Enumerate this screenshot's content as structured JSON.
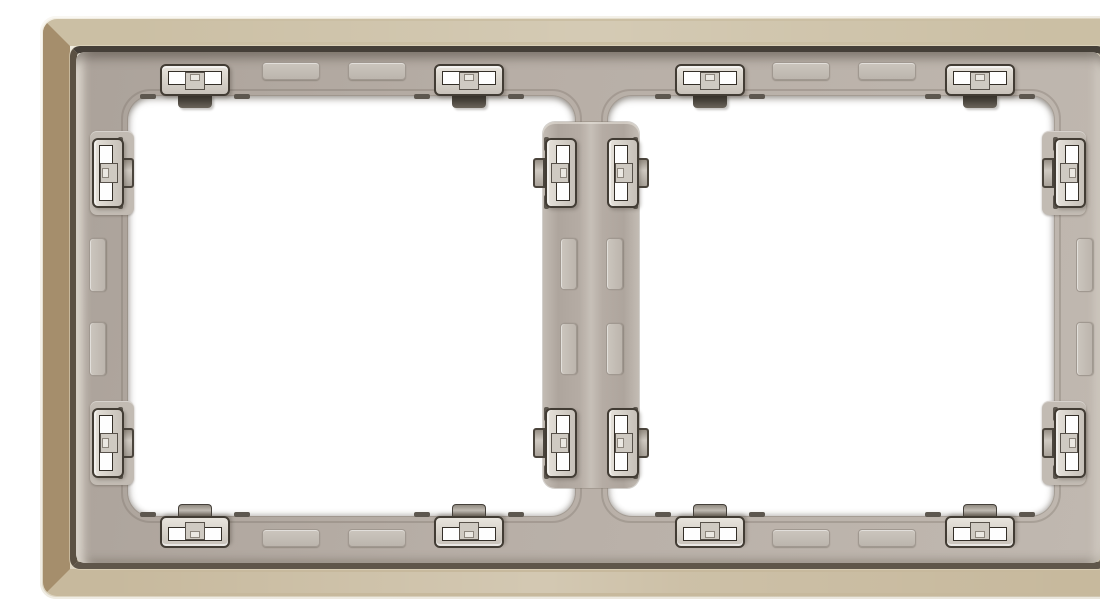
{
  "image": {
    "title": "Rear view of a two-gang champagne metallic wall-switch cover frame with grey plastic carrier and snap-in mounting clips",
    "type": "product-photo",
    "background": "#ffffff"
  },
  "product": {
    "kind": "wall switch cover frame",
    "view": "rear",
    "gangs": 2,
    "finish": "champagne metallic",
    "carrier_material": "grey plastic",
    "openings": [
      "left",
      "right"
    ],
    "clips_total": 16,
    "clips_per_opening": 8,
    "clip_positions": [
      "top-left",
      "top-right",
      "bottom-left",
      "bottom-right",
      "left-upper",
      "left-lower",
      "right-upper",
      "right-lower"
    ],
    "relief_bumps_total": 16
  },
  "colors": {
    "frame_top": "#cbbfa4",
    "frame_left": "#a58e6c",
    "frame_right": "#b29d7d",
    "frame_bottom": "#c7b99d",
    "frame_edge_light": "#f0ebdf",
    "seam_dark": "#453f38",
    "carrier_grey": "#b5aca4",
    "clip_body_grey": "#d8d3cc",
    "clip_outline": "#423c34",
    "latch_dark": "#3a342c",
    "opening_white": "#ffffff"
  }
}
